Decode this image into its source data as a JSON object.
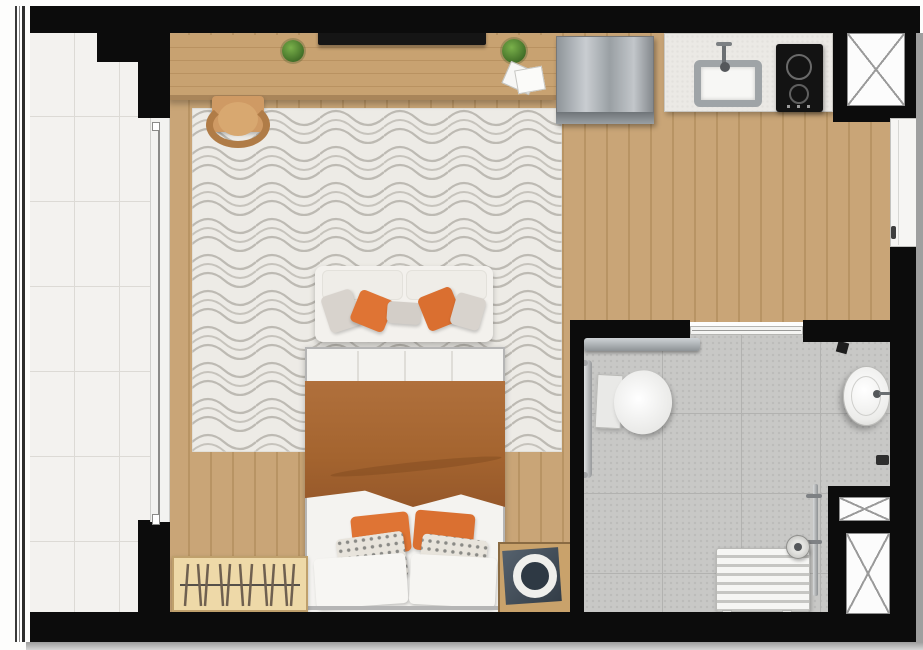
{
  "meta": {
    "title": "Studio apartment floor plan (top view)",
    "canvas_width": 923,
    "canvas_height": 650
  },
  "palette": {
    "wall": "#0c0c0c",
    "wood_floor": "#c9a577",
    "wood_plank_line": "#b89464",
    "balcony_tile": "#f3f2ef",
    "bathroom_tile": "#c8c8c6",
    "rug_base": "#edebe6",
    "rug_pattern": "#bdbab3",
    "sofa": "#f3f1ed",
    "bed_sheet": "#f6f5f2",
    "blanket_terracotta": "#a9662f",
    "pillow_orange": "#df7434",
    "pillow_gray": "#d8d3cd",
    "wardrobe": "#eed9a8",
    "stainless": "#a8adb1",
    "counter": "#ebe9e5",
    "cooktop": "#131313",
    "shaft_fill": "#fcfcfc",
    "door_white": "#f6f5f3",
    "shadow": "#9c9c9c"
  },
  "rooms": {
    "balcony": {
      "label": "Balcony with tiled floor and glass railing"
    },
    "living_bedroom": {
      "label": "Living / bedroom area with wood floor and patterned rug"
    },
    "kitchen": {
      "label": "Kitchen strip with counter, sink, cooktop and refrigerator"
    },
    "bathroom": {
      "label": "Bathroom with gray tile floor"
    },
    "entry": {
      "label": "Entry door on right wall"
    }
  },
  "furniture": {
    "railing": {
      "label": "balcony glass railing"
    },
    "sliding_door": {
      "label": "balcony sliding glass door"
    },
    "console": {
      "label": "wood TV console / desk"
    },
    "tv": {
      "label": "flat TV on console"
    },
    "plant_left": {
      "label": "potted plant"
    },
    "plant_right": {
      "label": "potted plant"
    },
    "papers": {
      "label": "papers / magazines on console"
    },
    "chair": {
      "label": "wooden chair tucked under desk"
    },
    "rug": {
      "label": "area rug with wavy geometric pattern"
    },
    "sofa": {
      "label": "white two-seat sofa with orange and gray pillows"
    },
    "bed": {
      "label": "double bed with terracotta blanket"
    },
    "wardrobe": {
      "label": "open wardrobe rack with hangers"
    },
    "washer": {
      "label": "washing machine in wood cabinet"
    },
    "fridge": {
      "label": "stainless refrigerator"
    },
    "counter": {
      "label": "kitchen countertop"
    },
    "kitchen_sink": {
      "label": "kitchen sink with faucet"
    },
    "cooktop": {
      "label": "two-burner black cooktop"
    },
    "shaft_kitchen": {
      "label": "service shaft (X)"
    },
    "shaft_small": {
      "label": "service shaft (X)"
    },
    "shaft_large": {
      "label": "service shaft (X)"
    },
    "entry_door": {
      "label": "apartment entry door"
    },
    "bath_door": {
      "label": "bathroom sliding door"
    },
    "toilet": {
      "label": "toilet"
    },
    "grab_bar": {
      "label": "grab bar beside toilet"
    },
    "bath_sink": {
      "label": "round washbasin"
    },
    "shower_head": {
      "label": "shower head"
    },
    "shower_bench": {
      "label": "slatted shower bench / radiator unit"
    },
    "towel_pipe": {
      "label": "vertical pipe / towel rail"
    }
  }
}
